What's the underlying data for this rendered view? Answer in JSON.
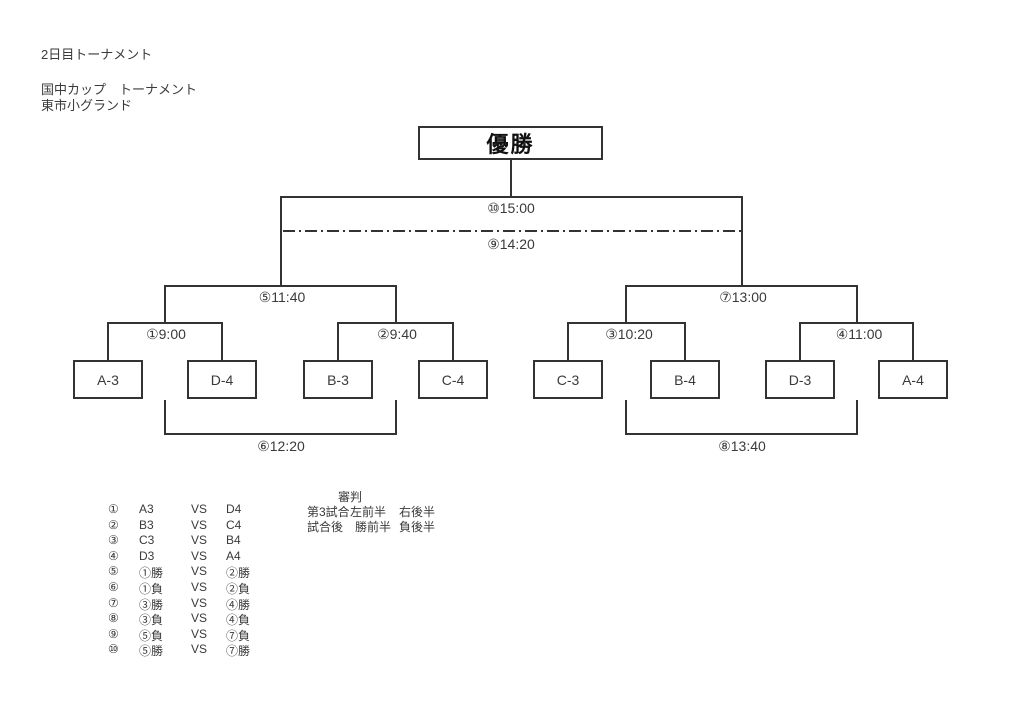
{
  "header": {
    "line1": "2日目トーナメント",
    "line2": "国中カップ　トーナメント",
    "line3": "東市小グランド"
  },
  "champion": {
    "label": "優勝"
  },
  "bracket": {
    "labels": {
      "m1": "①9:00",
      "m2": "②9:40",
      "m3": "③10:20",
      "m4": "④11:00",
      "m5": "⑤11:40",
      "m6": "⑥12:20",
      "m7": "⑦13:00",
      "m8": "⑧13:40",
      "m9": "⑨14:20",
      "m10": "⑩15:00"
    },
    "teams": [
      "A-3",
      "D-4",
      "B-3",
      "C-4",
      "C-3",
      "B-4",
      "D-3",
      "A-4"
    ]
  },
  "schedule": {
    "rows": [
      {
        "no": "①",
        "left": "A3",
        "vs": "VS",
        "right": "D4"
      },
      {
        "no": "②",
        "left": "B3",
        "vs": "VS",
        "right": "C4"
      },
      {
        "no": "③",
        "left": "C3",
        "vs": "VS",
        "right": "B4"
      },
      {
        "no": "④",
        "left": "D3",
        "vs": "VS",
        "right": "A4"
      },
      {
        "no": "⑤",
        "left": "①勝",
        "vs": "VS",
        "right": "②勝"
      },
      {
        "no": "⑥",
        "left": "①負",
        "vs": "VS",
        "right": "②負"
      },
      {
        "no": "⑦",
        "left": "③勝",
        "vs": "VS",
        "right": "④勝"
      },
      {
        "no": "⑧",
        "left": "③負",
        "vs": "VS",
        "right": "④負"
      },
      {
        "no": "⑨",
        "left": "⑤負",
        "vs": "VS",
        "right": "⑦負"
      },
      {
        "no": "⑩",
        "left": "⑤勝",
        "vs": "VS",
        "right": "⑦勝"
      }
    ]
  },
  "referee": {
    "title": "審判",
    "row1": {
      "c1": "第3試合",
      "c2": "左前半",
      "c3": "右後半"
    },
    "row2": {
      "c1": "試合後",
      "c2": "勝前半",
      "c3": "負後半"
    }
  },
  "colors": {
    "line": "#333333",
    "text": "#3a3a3a",
    "champion_text": "#111111"
  }
}
